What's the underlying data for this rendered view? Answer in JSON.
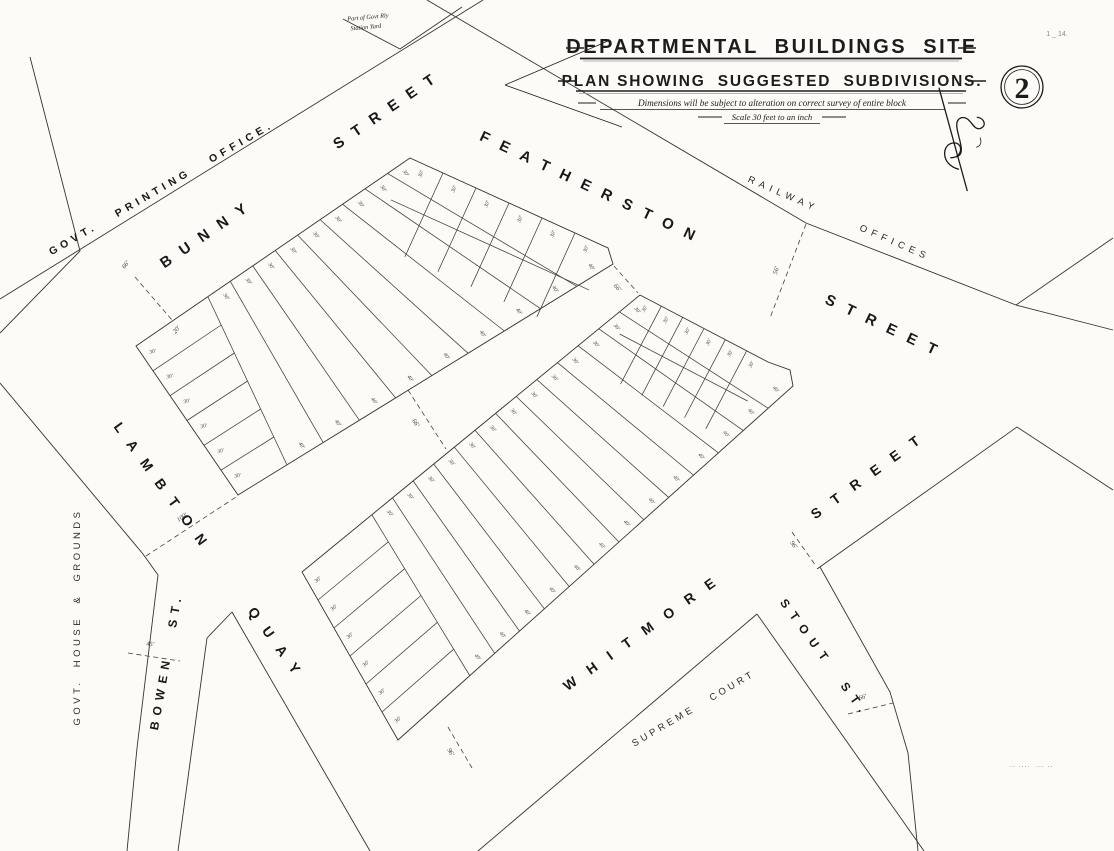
{
  "sheet": {
    "number": "2",
    "ref": "1 _ 14.",
    "imprint": ".. ....  ... .."
  },
  "title": {
    "line1": "DEPARTMENTAL  BUILDINGS  SITE",
    "line2": "PLAN SHOWING  SUGGESTED  SUBDIVISIONS.",
    "note": "Dimensions will be subject to alteration on correct survey of entire block",
    "scale": "Scale 30 feet to an inch"
  },
  "yard_note": {
    "line1": "Part of Govt Rly",
    "line2": "Station Yard"
  },
  "streets": {
    "printing": {
      "label": "GOVT.   PRINTING   OFFICE."
    },
    "bunny": {
      "label": "BUNNY      STREET"
    },
    "featherston": {
      "label": "FEATHERSTON        STREET"
    },
    "railway": {
      "label": "RAILWAY      OFFICES"
    },
    "lambton": {
      "label": "LAMBTON    QUAY"
    },
    "bowen": {
      "label": "BOWEN   ST."
    },
    "govt_house": {
      "label": "GOVT.  HOUSE  &  GROUNDS"
    },
    "whitmore": {
      "label": "WHITMORE"
    },
    "whitmore2": {
      "label": "STREET"
    },
    "stout": {
      "label": "STOUT  ST."
    },
    "supreme": {
      "label": "SUPREME   COURT"
    }
  },
  "dimensions": {
    "lot_frontage": "30′",
    "lot_depth": "40′",
    "crossings": {
      "c1": "66′",
      "c1b": "20′",
      "c2": "100′",
      "c3": "45′",
      "c4": "66′",
      "c5": "66′",
      "c6": "56′",
      "c7": "96′",
      "c8": "96′",
      "c9": "66′"
    }
  }
}
